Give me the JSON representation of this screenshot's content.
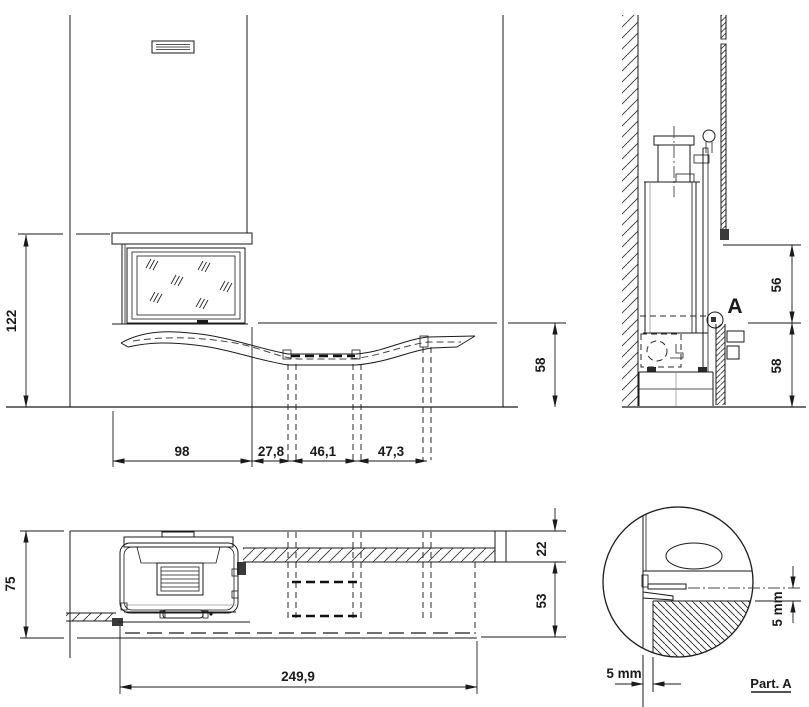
{
  "views": {
    "front": {
      "dim_overall_height": "122",
      "dim_firebox_width": "98",
      "dim_gap_width": "27,8",
      "dim_seat_width": "46,1",
      "dim_right_width": "47,3",
      "dim_bench_height": "58"
    },
    "side": {
      "dim_opening_height": "56",
      "dim_bench_height": "58",
      "detail_marker": "A"
    },
    "plan": {
      "dim_depth": "75",
      "dim_wall_thickness": "22",
      "dim_bench_depth": "53",
      "dim_overall_length": "249,9"
    },
    "detail": {
      "dim_gap_vertical": "5 mm",
      "dim_gap_horizontal": "5 mm",
      "caption": "Part. A"
    }
  },
  "colors": {
    "line": "#1a1a1a",
    "background": "#ffffff"
  }
}
